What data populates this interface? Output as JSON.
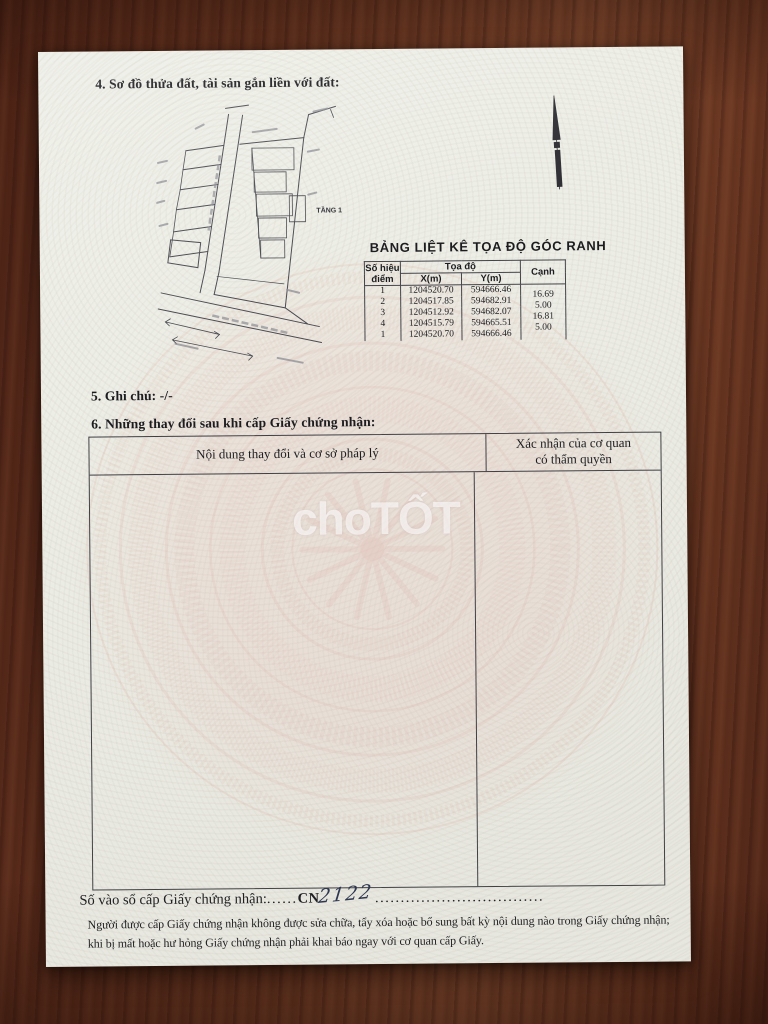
{
  "document": {
    "section4": {
      "heading": "4. Sơ đồ thửa đất, tài sản gắn liền với đất:"
    },
    "diagram": {
      "floor_label": "TẦNG 1"
    },
    "coord_table": {
      "title": "BẢNG LIỆT KÊ TỌA ĐỘ GÓC RANH",
      "header": {
        "point_line1": "Số hiệu",
        "point_line2": "điểm",
        "coord_group": "Tọa độ",
        "x": "X(m)",
        "y": "Y(m)",
        "edge": "Cạnh"
      },
      "rows": [
        {
          "point": "1",
          "x": "1204520.70",
          "y": "594666.46"
        },
        {
          "point": "2",
          "x": "1204517.85",
          "y": "594682.91"
        },
        {
          "point": "3",
          "x": "1204512.92",
          "y": "594682.07"
        },
        {
          "point": "4",
          "x": "1204515.79",
          "y": "594665.51"
        },
        {
          "point": "1",
          "x": "1204520.70",
          "y": "594666.46"
        }
      ],
      "edges": [
        "16.69",
        "5.00",
        "16.81",
        "5.00"
      ]
    },
    "section5": {
      "heading": "5. Ghi chú: -/-"
    },
    "section6": {
      "heading": "6. Những thay đổi sau khi cấp Giấy chứng nhận:"
    },
    "changes_table": {
      "col_content": "Nội dung thay đổi và cơ sở pháp lý",
      "col_confirm_line1": "Xác nhận của cơ quan",
      "col_confirm_line2": "có thẩm quyền"
    },
    "registry": {
      "label": "Số vào sổ cấp Giấy chứng nhận:",
      "leader1": "......",
      "prefix": "CN",
      "number_handwritten": "2122",
      "leader2": "................................."
    },
    "footer_note": "Người được cấp Giấy chứng nhận không được sửa chữa, tẩy xóa hoặc bổ sung bất kỳ nội dung nào trong Giấy chứng nhận; khi bị mất hoặc hư hỏng Giấy chứng nhận phải khai báo ngay với cơ quan cấp Giấy.",
    "watermark": "choTỐT"
  },
  "colors": {
    "paper": "#edeee6",
    "wood_dark": "#4c2316",
    "wood_mid": "#6f3b25",
    "ink": "#1c1c20",
    "drum_pink": "#d9a99e",
    "handwriting_ink": "#2a3550",
    "watermark_white": "rgba(255,255,255,0.66)"
  }
}
